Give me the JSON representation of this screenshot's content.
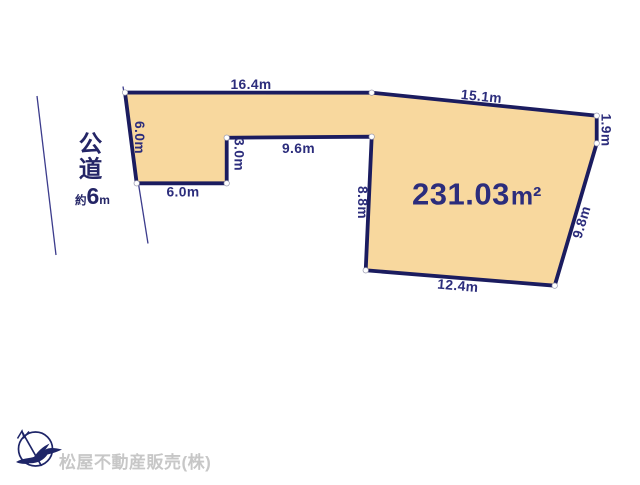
{
  "diagram": {
    "type": "land-plot-layout",
    "land_plot": {
      "area_value": "231.03",
      "area_unit": "m²",
      "edges": {
        "top": "16.4m",
        "upper_right": "15.1m",
        "right_short": "1.9m",
        "lower_right": "9.8m",
        "bottom": "12.4m",
        "mid_left_vertical": "8.8m",
        "notch_top": "9.6m",
        "notch_right": "3.0m",
        "notch_bottom": "6.0m",
        "left": "6.0m"
      }
    },
    "road": {
      "name": "公道",
      "width_prefix": "約",
      "width_value": "6",
      "width_unit": "m"
    }
  },
  "footer": {
    "company": "松屋不動産販売(株)"
  },
  "icons": {
    "compass": "north-arrow-bird-logo-icon"
  },
  "colors": {
    "plot_fill": "#f8d89e",
    "plot_border": "#1b1c5f",
    "dimension_text": "#2c2d7c",
    "road_text": "#242566",
    "road_line": "#3c3c8c",
    "company_text": "#c7c7c7",
    "vertex_dot": "#ffffff"
  }
}
